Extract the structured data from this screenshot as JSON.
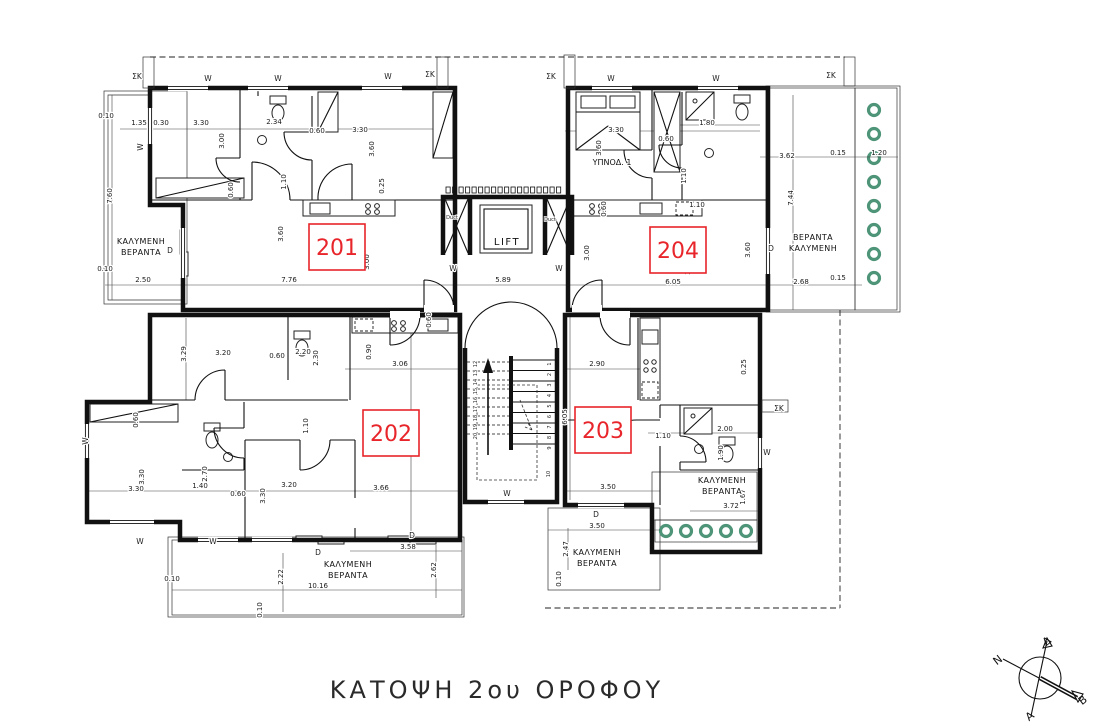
{
  "title": {
    "text": "ΚΑΤΟΨΗ 2ου ΟΡΟΦΟΥ"
  },
  "colors": {
    "line": "#111111",
    "apartment_red": "#e8252a",
    "plant_green": "#4d9478"
  },
  "apartments": [
    {
      "id": "201"
    },
    {
      "id": "202"
    },
    {
      "id": "203"
    },
    {
      "id": "204"
    }
  ],
  "labels": {
    "lift": "LIFT",
    "bedroom": "ΥΠΝΟΔ. 1",
    "ducts": [
      {
        "t": "Duct",
        "x": 452,
        "y": 219
      },
      {
        "t": "Duct",
        "x": 550,
        "y": 221
      }
    ],
    "verandas": [
      {
        "l1": "ΚΑΛΥΜΕΝΗ",
        "l2": "ΒΕΡΑΝΤΑ",
        "x": 141,
        "y": 247
      },
      {
        "l1": "ΒΕΡΑΝΤΑ",
        "l2": "ΚΑΛΥΜΕΝΗ",
        "x": 813,
        "y": 243
      },
      {
        "l1": "ΚΑΛΥΜΕΝΗ",
        "l2": "ΒΕΡΑΝΤΑ",
        "x": 348,
        "y": 570
      },
      {
        "l1": "ΚΑΛΥΜΕΝΗ",
        "l2": "ΒΕΡΑΝΤΑ",
        "x": 597,
        "y": 558
      },
      {
        "l1": "ΚΑΛΥΜΕΝΗ",
        "l2": "ΒΕΡΑΝΤΑ",
        "x": 722,
        "y": 486
      }
    ]
  },
  "dimensions": [
    {
      "t": "0.10",
      "x": 106,
      "y": 118
    },
    {
      "t": "1.35",
      "x": 139,
      "y": 125
    },
    {
      "t": "0.30",
      "x": 161,
      "y": 125
    },
    {
      "t": "3.30",
      "x": 201,
      "y": 125
    },
    {
      "t": "2.34",
      "x": 274,
      "y": 124
    },
    {
      "t": "0.60",
      "x": 317,
      "y": 133
    },
    {
      "t": "3.30",
      "x": 360,
      "y": 132
    },
    {
      "t": "3.00",
      "x": 224,
      "y": 141,
      "r": 1
    },
    {
      "t": "3.60",
      "x": 374,
      "y": 149,
      "r": 1
    },
    {
      "t": "1.10",
      "x": 286,
      "y": 182,
      "r": 1
    },
    {
      "t": "0.60",
      "x": 233,
      "y": 190,
      "r": 1
    },
    {
      "t": "0.25",
      "x": 384,
      "y": 186,
      "r": 1
    },
    {
      "t": "7.60",
      "x": 112,
      "y": 196,
      "r": 1
    },
    {
      "t": "3.60",
      "x": 283,
      "y": 234,
      "r": 1
    },
    {
      "t": "3.00",
      "x": 369,
      "y": 262,
      "r": 1
    },
    {
      "t": "0.10",
      "x": 105,
      "y": 271
    },
    {
      "t": "2.50",
      "x": 143,
      "y": 282
    },
    {
      "t": "7.76",
      "x": 289,
      "y": 282
    },
    {
      "t": "5.89",
      "x": 503,
      "y": 282
    },
    {
      "t": "6.05",
      "x": 673,
      "y": 284
    },
    {
      "t": "2.68",
      "x": 801,
      "y": 284
    },
    {
      "t": "3.30",
      "x": 616,
      "y": 132
    },
    {
      "t": "3.60",
      "x": 601,
      "y": 148,
      "r": 1
    },
    {
      "t": "1.80",
      "x": 707,
      "y": 125
    },
    {
      "t": "0.60",
      "x": 666,
      "y": 141
    },
    {
      "t": "1.10",
      "x": 686,
      "y": 176,
      "r": 1
    },
    {
      "t": "1.10",
      "x": 697,
      "y": 207
    },
    {
      "t": "3.62",
      "x": 787,
      "y": 158
    },
    {
      "t": "0.15",
      "x": 838,
      "y": 155
    },
    {
      "t": "1.20",
      "x": 879,
      "y": 155
    },
    {
      "t": "7.44",
      "x": 793,
      "y": 198,
      "r": 1
    },
    {
      "t": "3.00",
      "x": 589,
      "y": 253,
      "r": 1
    },
    {
      "t": "0.60",
      "x": 606,
      "y": 209,
      "r": 1
    },
    {
      "t": "3.60",
      "x": 750,
      "y": 250,
      "r": 1
    },
    {
      "t": "3.60",
      "x": 690,
      "y": 267,
      "r": 1
    },
    {
      "t": "0.15",
      "x": 838,
      "y": 280
    },
    {
      "t": "3.29",
      "x": 186,
      "y": 354,
      "r": 1
    },
    {
      "t": "3.20",
      "x": 223,
      "y": 355
    },
    {
      "t": "2.20",
      "x": 303,
      "y": 354
    },
    {
      "t": "2.30",
      "x": 318,
      "y": 358,
      "r": 1
    },
    {
      "t": "0.60",
      "x": 277,
      "y": 358
    },
    {
      "t": "0.90",
      "x": 371,
      "y": 352,
      "r": 1
    },
    {
      "t": "3.06",
      "x": 400,
      "y": 366
    },
    {
      "t": "0.60",
      "x": 431,
      "y": 320,
      "r": 1
    },
    {
      "t": "6.85",
      "x": 412,
      "y": 426,
      "r": 1
    },
    {
      "t": "1.10",
      "x": 308,
      "y": 426,
      "r": 1
    },
    {
      "t": "0.60",
      "x": 138,
      "y": 420,
      "r": 1
    },
    {
      "t": "3.30",
      "x": 144,
      "y": 477,
      "r": 1
    },
    {
      "t": "3.30",
      "x": 136,
      "y": 491
    },
    {
      "t": "2.70",
      "x": 207,
      "y": 474,
      "r": 1
    },
    {
      "t": "1.40",
      "x": 200,
      "y": 488
    },
    {
      "t": "0.60",
      "x": 238,
      "y": 496
    },
    {
      "t": "3.30",
      "x": 265,
      "y": 496,
      "r": 1
    },
    {
      "t": "3.20",
      "x": 289,
      "y": 487
    },
    {
      "t": "3.66",
      "x": 381,
      "y": 490
    },
    {
      "t": "3.58",
      "x": 408,
      "y": 549
    },
    {
      "t": "2.62",
      "x": 436,
      "y": 570,
      "r": 1
    },
    {
      "t": "10.16",
      "x": 318,
      "y": 588
    },
    {
      "t": "2.22",
      "x": 283,
      "y": 577,
      "r": 1
    },
    {
      "t": "0.10",
      "x": 172,
      "y": 581
    },
    {
      "t": "0.10",
      "x": 262,
      "y": 610,
      "r": 1
    },
    {
      "t": "2.90",
      "x": 597,
      "y": 366
    },
    {
      "t": "6.05",
      "x": 567,
      "y": 417,
      "r": 1
    },
    {
      "t": "1.10",
      "x": 663,
      "y": 438
    },
    {
      "t": "2.00",
      "x": 725,
      "y": 431
    },
    {
      "t": "1.90",
      "x": 723,
      "y": 453,
      "r": 1
    },
    {
      "t": "0.25",
      "x": 746,
      "y": 367,
      "r": 1
    },
    {
      "t": "3.50",
      "x": 608,
      "y": 489
    },
    {
      "t": "3.50",
      "x": 597,
      "y": 528
    },
    {
      "t": "2.47",
      "x": 568,
      "y": 549,
      "r": 1
    },
    {
      "t": "0.10",
      "x": 561,
      "y": 579,
      "r": 1
    },
    {
      "t": "3.72",
      "x": 731,
      "y": 508
    },
    {
      "t": "1.67",
      "x": 745,
      "y": 497,
      "r": 1
    }
  ],
  "markers": [
    {
      "t": "ΣΚ",
      "x": 137,
      "y": 79
    },
    {
      "t": "ΣΚ",
      "x": 430,
      "y": 77
    },
    {
      "t": "ΣΚ",
      "x": 551,
      "y": 79
    },
    {
      "t": "ΣΚ",
      "x": 831,
      "y": 78
    },
    {
      "t": "ΣΚ",
      "x": 779,
      "y": 411
    },
    {
      "t": "W",
      "x": 208,
      "y": 81
    },
    {
      "t": "W",
      "x": 278,
      "y": 81
    },
    {
      "t": "W",
      "x": 388,
      "y": 79
    },
    {
      "t": "W",
      "x": 611,
      "y": 81
    },
    {
      "t": "W",
      "x": 716,
      "y": 81
    },
    {
      "t": "W",
      "x": 143,
      "y": 147,
      "r": 1
    },
    {
      "t": "W",
      "x": 453,
      "y": 271
    },
    {
      "t": "W",
      "x": 559,
      "y": 271
    },
    {
      "t": "W",
      "x": 88,
      "y": 441,
      "r": 1
    },
    {
      "t": "W",
      "x": 140,
      "y": 544
    },
    {
      "t": "W",
      "x": 213,
      "y": 544
    },
    {
      "t": "W",
      "x": 767,
      "y": 455
    },
    {
      "t": "W",
      "x": 507,
      "y": 496
    },
    {
      "t": "D",
      "x": 170,
      "y": 253
    },
    {
      "t": "D",
      "x": 771,
      "y": 251
    },
    {
      "t": "D",
      "x": 318,
      "y": 555
    },
    {
      "t": "D",
      "x": 412,
      "y": 538
    },
    {
      "t": "D",
      "x": 596,
      "y": 517
    }
  ],
  "stairs": {
    "flight_down": [
      "1",
      "2",
      "3",
      "4",
      "5",
      "6",
      "7",
      "8",
      "9"
    ],
    "landing": "10",
    "flight_up": [
      "12",
      "13",
      "14",
      "15",
      "16",
      "17",
      "18",
      "19",
      "20"
    ]
  },
  "compass": {
    "letters": [
      {
        "t": "Δ",
        "x": 1049,
        "y": 644
      },
      {
        "t": "Ν",
        "x": 1000,
        "y": 663
      },
      {
        "t": "Β",
        "x": 1085,
        "y": 703
      },
      {
        "t": "Α",
        "x": 1032,
        "y": 719
      }
    ]
  }
}
